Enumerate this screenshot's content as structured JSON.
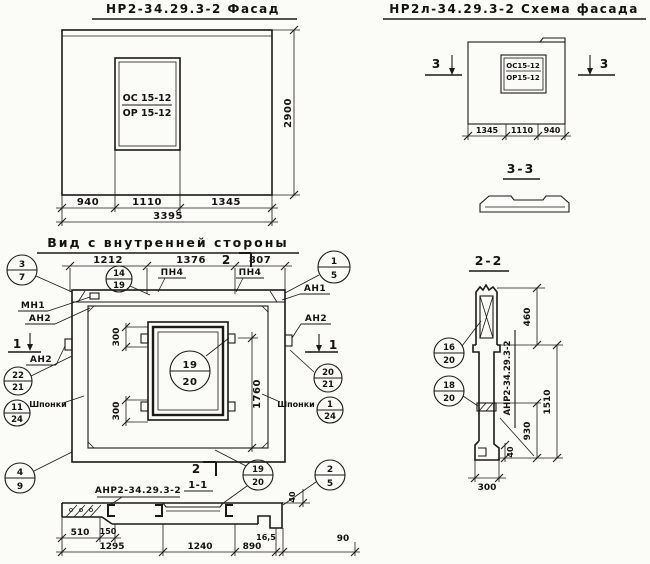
{
  "sheet": {
    "facade": {
      "title": "НР2-34.29.3-2  Фасад",
      "window_mark_top": "ОС 15-12",
      "window_mark_bot": "ОР 15-12",
      "dim_940": "940",
      "dim_1110": "1110",
      "dim_1345": "1345",
      "dim_total": "3395",
      "dim_height": "2900"
    },
    "scheme": {
      "title": "НР2л-34.29.3-2  Схема фасада",
      "window_mark_top": "ОС15-12",
      "window_mark_bot": "ОР15-12",
      "dim_1345": "1345",
      "dim_1110": "1110",
      "dim_940": "940",
      "cut_label": "3",
      "section33_title": "3-3"
    },
    "inner": {
      "title": "Вид с внутренней стороны",
      "dim_1212": "1212",
      "dim_1376": "1376",
      "dim_807": "807",
      "cut2_label": "2",
      "cut1_label": "1",
      "pn4": "ПН4",
      "mn1": "МН1",
      "an1": "АН1",
      "an2": "АН2",
      "shponki": "Шпонки",
      "dim_300": "300",
      "dim_1760": "1760",
      "callouts": {
        "c3_7": {
          "top": "3",
          "bot": "7"
        },
        "c14_19": {
          "top": "14",
          "bot": "19"
        },
        "c1_5": {
          "top": "1",
          "bot": "5"
        },
        "c22_21": {
          "top": "22",
          "bot": "21"
        },
        "c11_24": {
          "top": "11",
          "bot": "24"
        },
        "c20_21": {
          "top": "20",
          "bot": "21"
        },
        "c1_24": {
          "top": "1",
          "bot": "24"
        },
        "c4_9": {
          "top": "4",
          "bot": "9"
        },
        "c19_20": {
          "top": "19",
          "bot": "20"
        },
        "c2_5": {
          "top": "2",
          "bot": "5"
        }
      }
    },
    "section11": {
      "label": "АНР2-34.29.3-2",
      "title": "1-1",
      "cut2_label": "2",
      "dim_510": "510",
      "dim_150": "150",
      "dim_1295": "1295",
      "dim_1240": "1240",
      "dim_890": "890",
      "dim_165": "16,5",
      "dim_90": "90",
      "dim_40": "40"
    },
    "section22": {
      "title": "2-2",
      "label": "АНР2-34.29.3-2",
      "dim_460": "460",
      "dim_1510": "1510",
      "dim_930": "930",
      "dim_40": "40",
      "dim_300": "300",
      "callouts": {
        "c16_20": {
          "top": "16",
          "bot": "20"
        },
        "c18_20": {
          "top": "18",
          "bot": "20"
        }
      }
    }
  }
}
